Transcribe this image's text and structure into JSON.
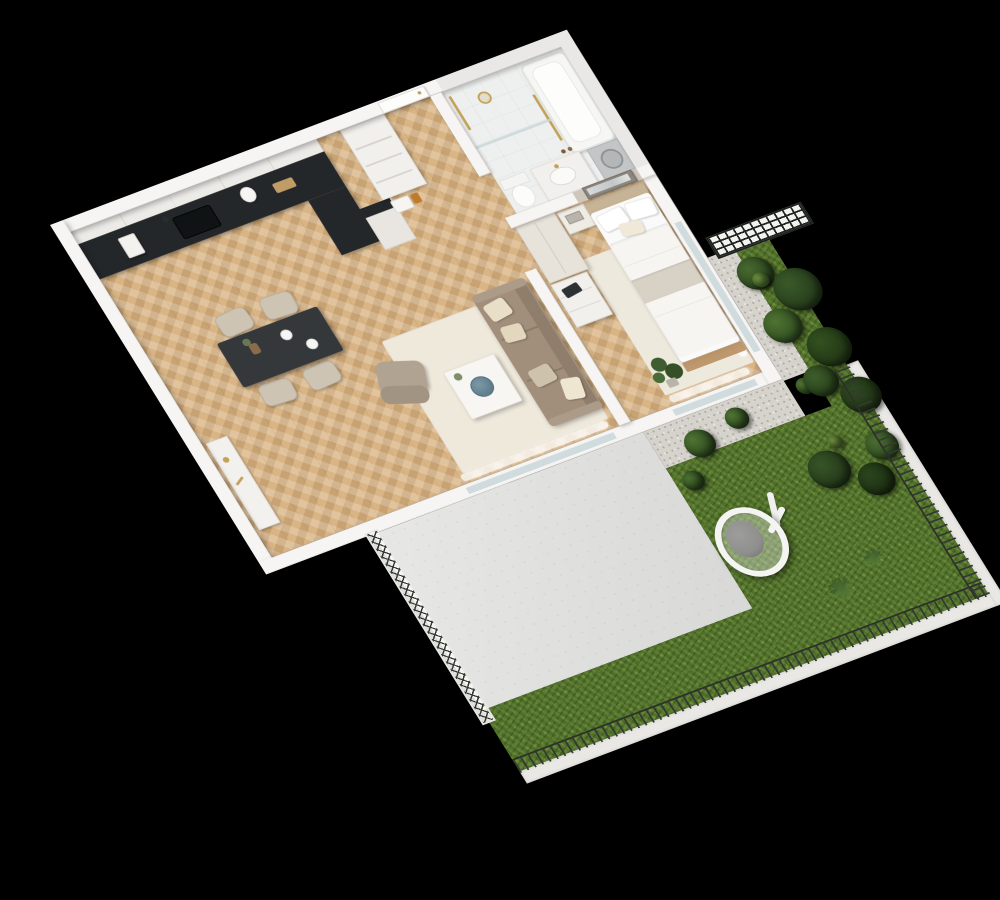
{
  "scene": {
    "description": "Photorealistic 3D axonometric render of a one-bedroom apartment floor plan with private garden terrace, viewed from above, on a solid black background",
    "style": "white cutaway walls, oak herringbone parquet, beige and taupe furnishings, gold fixtures",
    "rotation_deg": -22,
    "visible_text": "none"
  },
  "palette": {
    "black": "#000000",
    "wallWhite": "#f6f5f3",
    "wallShade": "#e3e1de",
    "floorWood": "#d9b586",
    "counterBlack": "#24272a",
    "cabinetWhite": "#ecebe7",
    "cream": "#e8e3da",
    "taupe": "#a18f7c",
    "cushionCream": "#e9dfc9",
    "rugCream": "#efe9dc",
    "tableDark": "#34383b",
    "chairBeige": "#cdc4b4",
    "bathTile": "#eef0ef",
    "marble": "#e9e8e6",
    "gold": "#c2a258",
    "bedWhite": "#fbfafa",
    "throwGrey": "#d8d1c6",
    "woodFrame": "#b98f60",
    "greigeWall": "#cfc7bc",
    "concrete": "#dfe0dd",
    "gravel": "#d6d3cc",
    "grass": "#4f7029",
    "grassLight": "#759440",
    "bushDark": "#2e4a20",
    "fenceDark": "#343a31",
    "glassBlue": "#c9d6d9",
    "eggChairGrey": "#8f8f8d"
  },
  "apartment": {
    "kitchen": {
      "label": "Kitchen",
      "furniture": [
        "white upper cabinets with glass doors",
        "black countertop L-shape",
        "black undermount sink with gooseneck faucet",
        "white coffee machine",
        "white kettle",
        "cutting board",
        "built-in oven",
        "tall cabinet with open shelves"
      ]
    },
    "dining": {
      "label": "Dining area",
      "furniture": [
        "dark stone dining table",
        "four beige upholstered chairs",
        "vase with dried plant",
        "white plates"
      ]
    },
    "living": {
      "label": "Living room",
      "furniture": [
        "taupe three-seat sofa with cream pillows",
        "cream rug",
        "white square coffee table",
        "blue decorative plate",
        "green vase plant",
        "taupe accent chair with gold legs",
        "white console table with gold decor",
        "sheer curtains at terrace glazing"
      ]
    },
    "hall": {
      "label": "Entrance hall",
      "furniture": [
        "white entrance door with handle",
        "open shelving niche unit",
        "small countertop appliances"
      ]
    },
    "bathroom": {
      "label": "Bathroom",
      "furniture": [
        "white bathtub",
        "gold rain shower and rail",
        "glass shower screen",
        "white vanity with round basin and gold tap",
        "toilet",
        "washing machine",
        "marble-clad walls",
        "amber bottles"
      ]
    },
    "bedroom": {
      "label": "Bedroom",
      "furniture": [
        "double bed with white bedding",
        "two white pillows and cream accent cushion",
        "beige throw blanket",
        "wood bed frame",
        "nightstand with books",
        "tall cream wardrobe",
        "white dresser with laptop",
        "framed picture above headboard",
        "monstera plant",
        "sheer curtains",
        "cream rug",
        "greige accent wall"
      ]
    }
  },
  "outdoor": {
    "terrace": {
      "label": "Concrete patio",
      "features": [
        "light grey concrete slab adjoining the apartment glazing"
      ]
    },
    "garden": {
      "label": "Garden",
      "features": [
        "lush green lawn",
        "gravel strip below bedroom windows",
        "four clipped boxwood balls",
        "tall shrub border",
        "fan-leaf plants",
        "white hanging egg chair with grey cushion",
        "thin wire picket fence on south and east edges",
        "diamond-mesh fence panel on west edge",
        "dark grid trellis panel at north-east corner",
        "white concrete curb outside the fence"
      ]
    }
  },
  "aria": {
    "stage": "3D floor plan render on black background",
    "plan": "Axonometric apartment floor plan",
    "apartment": "One-bedroom apartment interior",
    "kitchen": "Kitchen with black countertop",
    "dining": "Dining area with dark table and four chairs",
    "living": "Living room with taupe sofa and coffee table",
    "hall": "Entrance hall with front door",
    "bathroom": "Bathroom with tub, vanity and gold fixtures",
    "bedroom": "Bedroom with double bed and wardrobe",
    "terrace": "Concrete patio",
    "garden": "Fenced grass garden with hanging egg chair",
    "eggchair": "White hanging egg chair with grey cushion"
  }
}
